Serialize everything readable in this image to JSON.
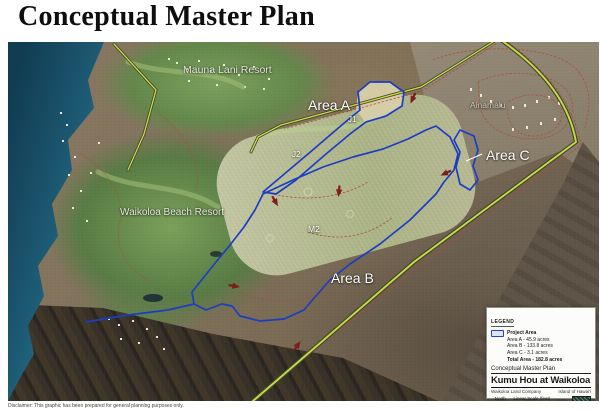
{
  "title": "Conceptual Master Plan",
  "disclaimer": "Disclaimer: This graphic has been prepared for general planning purposes only.",
  "map_labels": {
    "mauna_lani": "Mauna Lani Resort",
    "ainamalu": "Ainamalu",
    "area_a": "Area A",
    "j1": "J1",
    "j2": "J2",
    "m2": "M2",
    "area_b": "Area B",
    "area_c": "Area C",
    "waikoloa_beach": "Waikoloa Beach Resort"
  },
  "legend": {
    "heading": "LEGEND",
    "project_area_label": "Project Area",
    "areas": [
      "Area A - 45.9 acres",
      "Area B - 133.8 acres",
      "Area C - 3.1 acres"
    ],
    "total": "Total Area - 182.8 acres",
    "plan_type": "Conceptual Master Plan",
    "project_title": "Kumu Hou at Waikoloa",
    "company": "Waikoloa Land Company",
    "island": "Island of Hawai'i",
    "north_label": "North",
    "scale_label": "Linear Scale (feet)",
    "scale_ticks": [
      "0",
      "400",
      "800",
      "1,600"
    ],
    "logo_text": "PBR HAWAII"
  },
  "colors": {
    "ocean": "#1d5a73",
    "boundary_blue": "#1c3ec2",
    "road_yellow": "#c9da49",
    "parcel_red": "#b0493b",
    "arrow_red": "#7d1d1d"
  }
}
